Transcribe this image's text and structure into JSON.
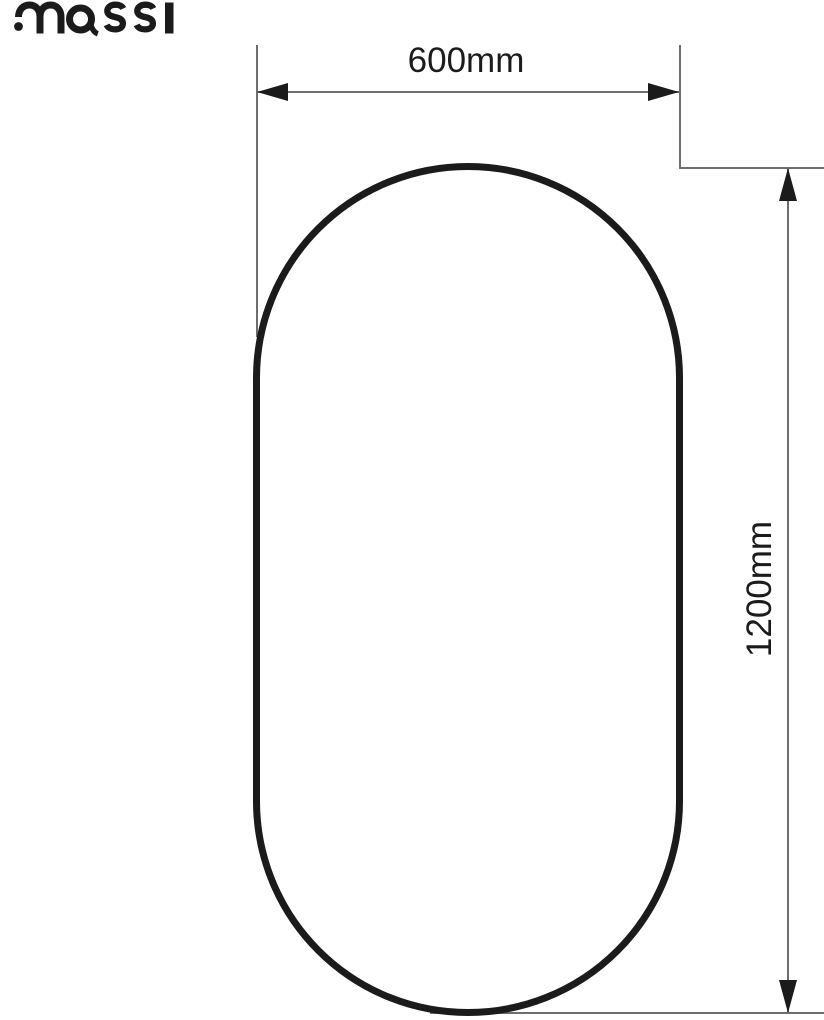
{
  "brand": {
    "name": "massi"
  },
  "diagram": {
    "type": "product-dimension-drawing",
    "shape": "rounded-capsule-mirror-outline",
    "dimensions": {
      "width": {
        "label": "600mm",
        "value_mm": 600,
        "orientation": "horizontal"
      },
      "height": {
        "label": "1200mm",
        "value_mm": 1200,
        "orientation": "vertical"
      }
    },
    "colors": {
      "outline": "#1b1b1b",
      "dim_line": "#6e6e6e",
      "arrow": "#1b1b1b",
      "text": "#1b1b1b",
      "background": "#ffffff"
    }
  }
}
